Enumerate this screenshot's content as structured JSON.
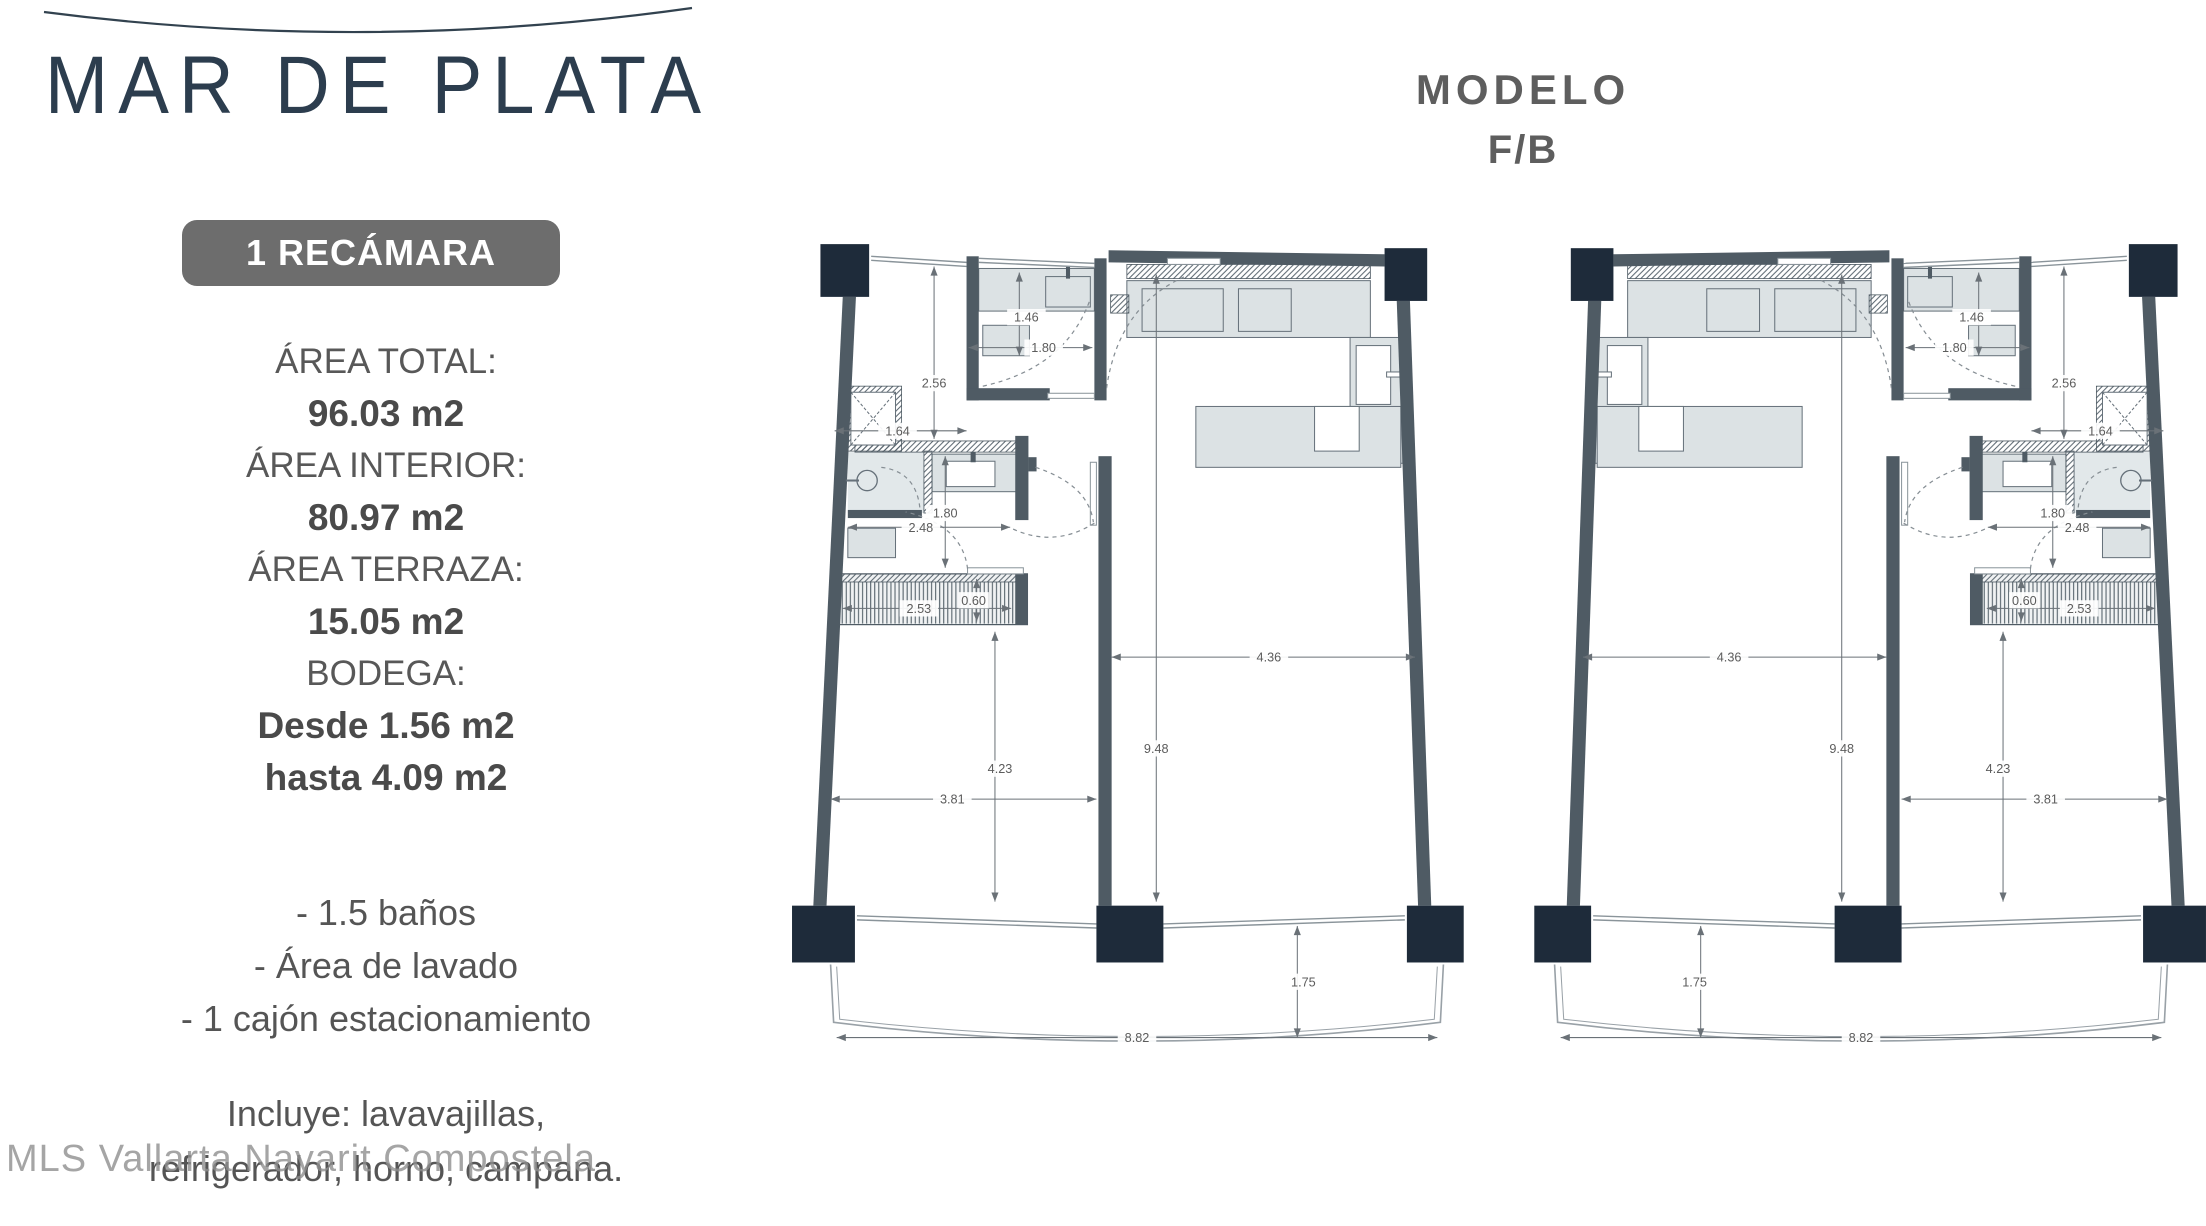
{
  "brand": {
    "title": "MAR DE PLATA"
  },
  "model": {
    "line1": "MODELO",
    "line2": "F/B"
  },
  "badge": {
    "label": "1 RECÁMARA"
  },
  "specs": [
    {
      "label": "ÁREA TOTAL:",
      "value": "96.03 m2"
    },
    {
      "label": "ÁREA INTERIOR:",
      "value": "80.97 m2"
    },
    {
      "label": "ÁREA TERRAZA:",
      "value": "15.05 m2"
    },
    {
      "label": "BODEGA:",
      "value": "Desde 1.56 m2",
      "value2": "hasta 4.09 m2"
    }
  ],
  "features": [
    "- 1.5 baños",
    "- Área de lavado",
    "- 1 cajón estacionamiento"
  ],
  "includes": [
    "Incluye: lavavajillas,",
    "refrigerador, horno, campana."
  ],
  "watermark": "MLS Vallarta Nayarit Compostela",
  "floorplan": {
    "dims": {
      "laundry_h": "1.46",
      "laundry_w": "1.80",
      "hall_h": "2.56",
      "hall_w": "1.64",
      "bath_h": "1.80",
      "bath_w": "2.48",
      "terrace_w": "2.53",
      "terrace_d": "0.60",
      "interior_h": "9.48",
      "living_w": "4.36",
      "bedroom_h": "4.23",
      "bedroom_w": "3.81",
      "balcony_d": "1.75",
      "balcony_w": "8.82"
    },
    "colors": {
      "column": "#1e2b3a",
      "wall": "#4f5b64",
      "furniture_fill": "#dce2e4",
      "furniture_stroke": "#66717a",
      "floor_fill": "#e2e8ea",
      "dim_line": "#6a7177",
      "dim_text": "#5c5c5c",
      "window": "#8a949a",
      "arc": "#868e94",
      "balcony": "#99a1a7",
      "title": "#2c3d4e"
    }
  }
}
